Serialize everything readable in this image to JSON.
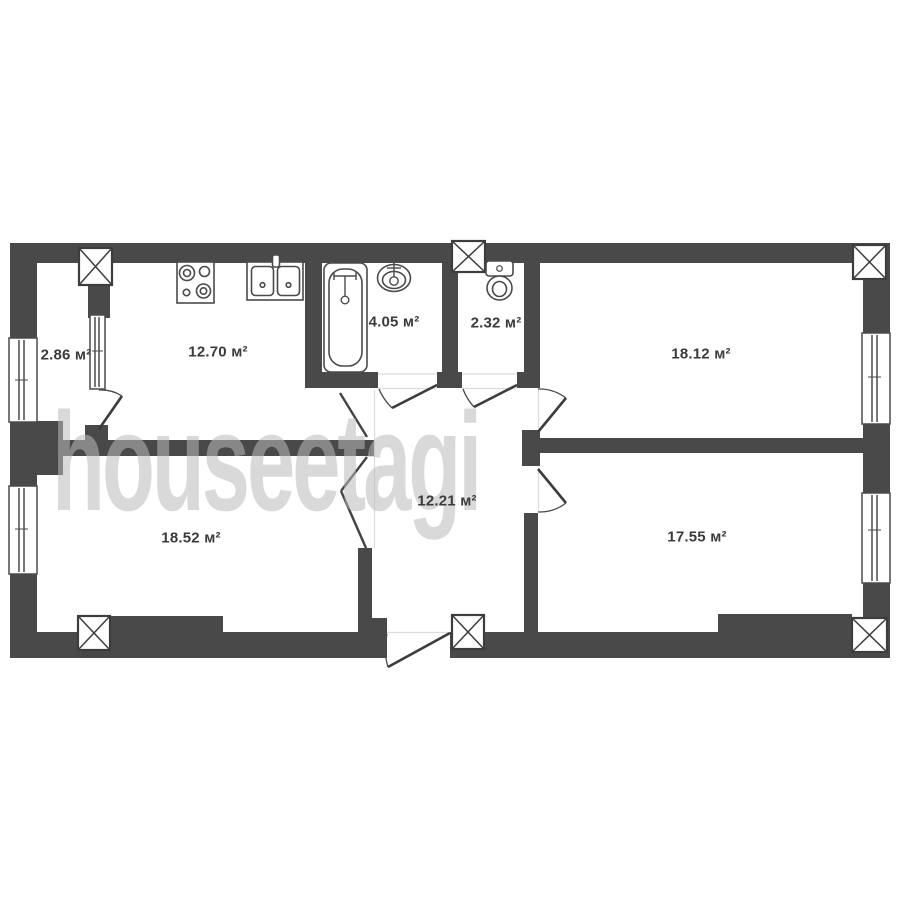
{
  "watermark": "houseetagi",
  "colors": {
    "wall": "#494949",
    "label": "#3b3b3b",
    "background": "#ffffff",
    "watermark": "rgba(186,186,186,0.55)"
  },
  "rooms": {
    "loggia": {
      "area": "2.86 м²"
    },
    "kitchen": {
      "area": "12.70 м²"
    },
    "bathroom": {
      "area": "4.05 м²"
    },
    "toilet": {
      "area": "2.32 м²"
    },
    "room_top_right": {
      "area": "18.12 м²"
    },
    "room_bottom_left": {
      "area": "18.52 м²"
    },
    "hallway": {
      "area": "12.21 м²"
    },
    "room_bottom_right": {
      "area": "17.55 м²"
    }
  }
}
